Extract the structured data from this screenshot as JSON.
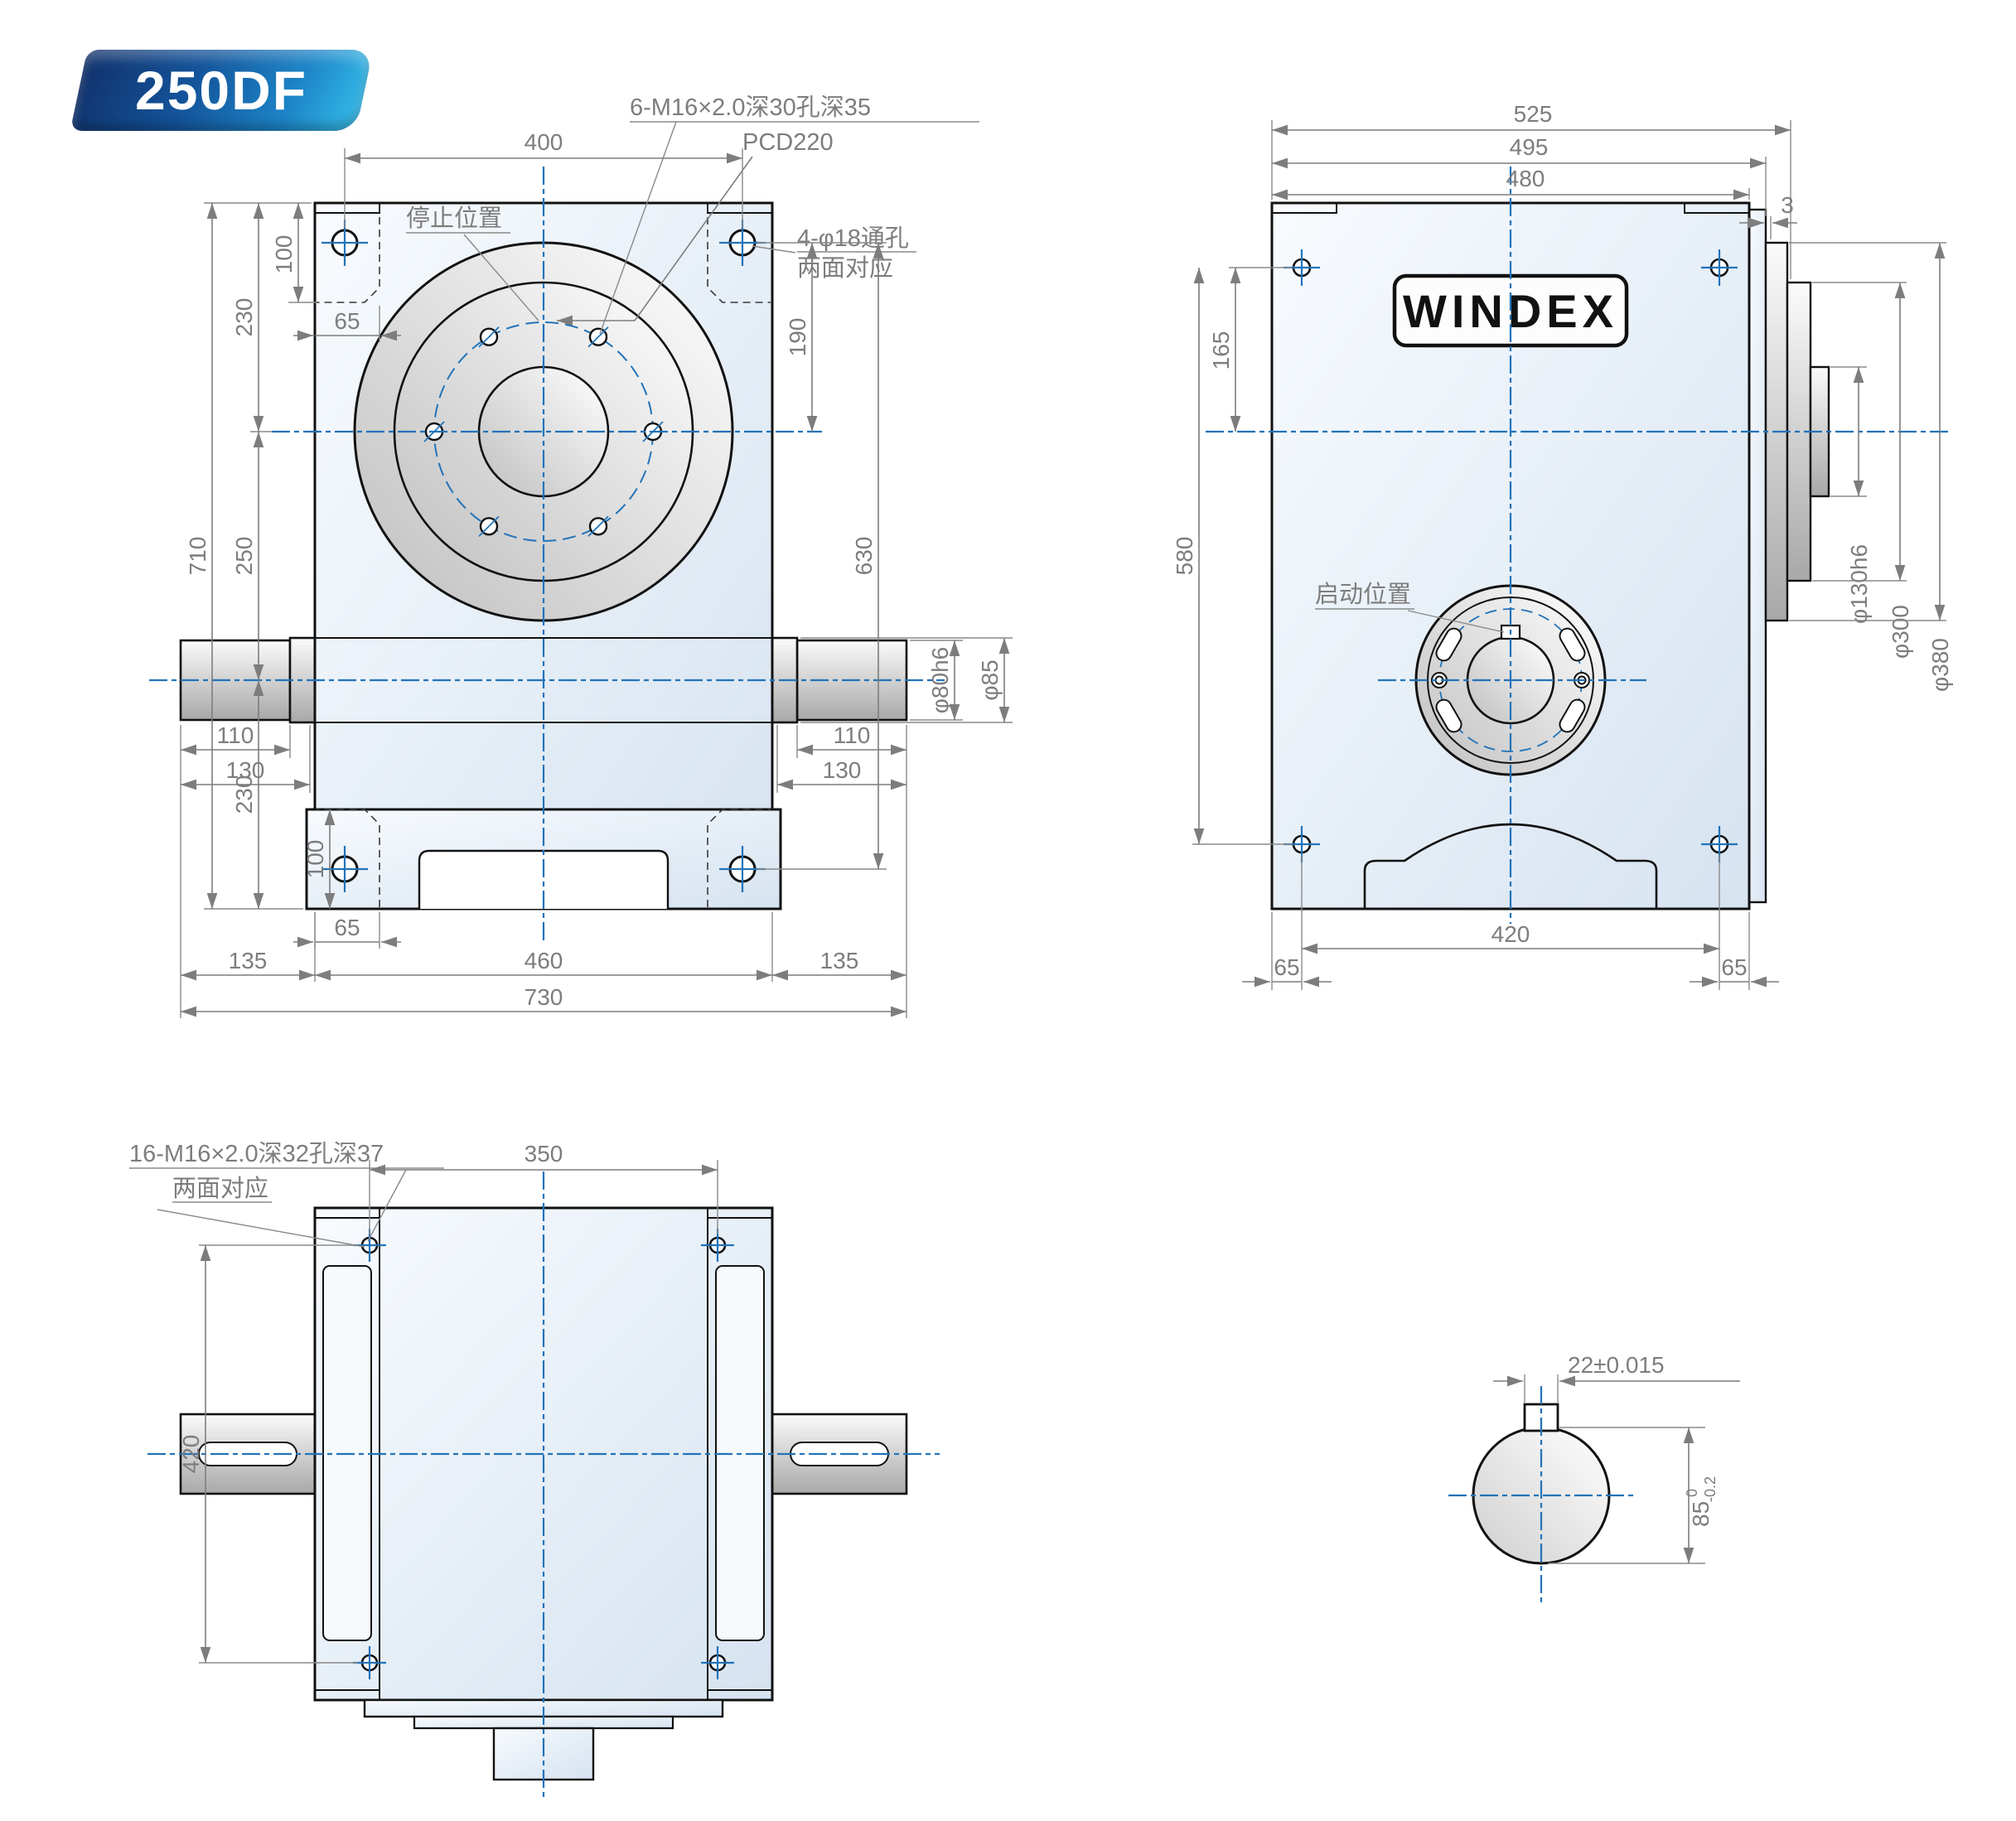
{
  "badge": {
    "model": "250DF"
  },
  "front": {
    "note_tap": "6-M16×2.0深30孔深35",
    "note_pcd": "PCD220",
    "note_stop": "停止位置",
    "note_hole": "4-φ18通孔",
    "note_both": "两面对应",
    "d400": "400",
    "d100t": "100",
    "d230t": "230",
    "d65t": "65",
    "d710": "710",
    "d250": "250",
    "d230b": "230",
    "d100b": "100",
    "d65b": "65",
    "d110l": "110",
    "d130l": "130",
    "d135l": "135",
    "d460": "460",
    "d135r": "135",
    "d730": "730",
    "d190": "190",
    "d630": "630",
    "d80": "φ80h6",
    "d85": "φ85",
    "d110r": "110",
    "d130r": "130"
  },
  "side": {
    "brand": "WINDEX",
    "note_start": "启动位置",
    "d525": "525",
    "d495": "495",
    "d480": "480",
    "d3": "3",
    "d165": "165",
    "d580": "580",
    "d130h6": "φ130h6",
    "d300": "φ300",
    "d380": "φ380",
    "d420": "420",
    "d65l": "65",
    "d65r": "65"
  },
  "bottom": {
    "note_tap": "16-M16×2.0深32孔深37",
    "note_both": "两面对应",
    "d350": "350",
    "d420": "420"
  },
  "section": {
    "key": "22±0.015",
    "dia": "85",
    "tol_up": "0",
    "tol_low": "-0.2"
  },
  "colors": {
    "accent": "#2273b8",
    "outline": "#111111",
    "dim": "#7d7d7d"
  }
}
